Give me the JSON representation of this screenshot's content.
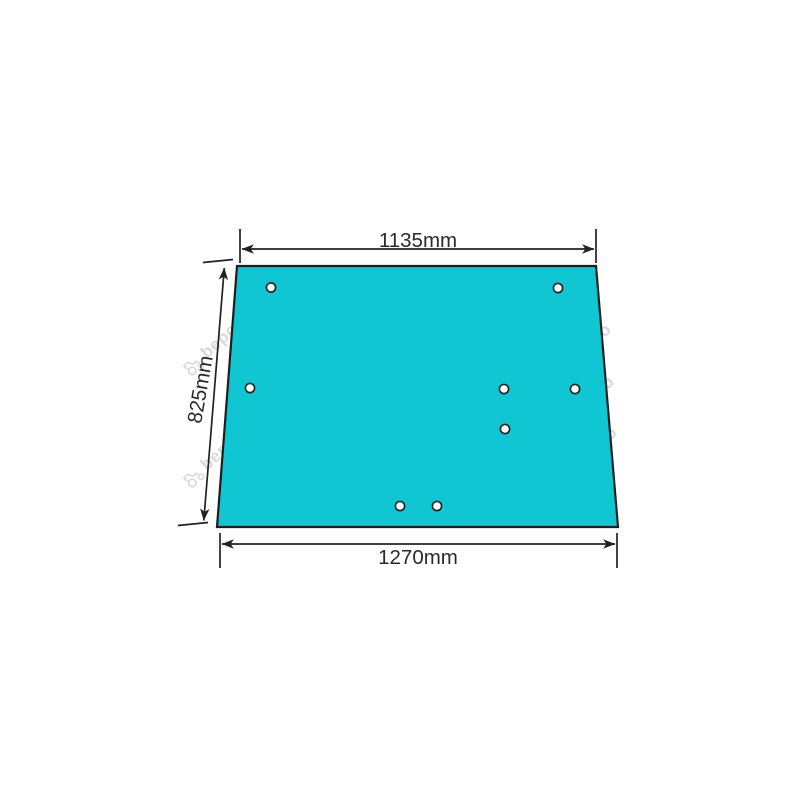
{
  "canvas": {
    "background_color": "#FFFFFF",
    "width_px": 800,
    "height_px": 800
  },
  "diagram": {
    "type": "technical-dimension-drawing",
    "glass_panel": {
      "shape": "trapezoid",
      "fill_color": "#10C6D3",
      "outline_color": "#1E1E1E"
    },
    "dimensions": {
      "top_width": "1135mm",
      "side_height": "825mm",
      "bottom_width": "1270mm"
    },
    "annotation_style": {
      "line_color": "#222222",
      "text_color": "#2A2A2A"
    },
    "holes": {
      "count": 8,
      "radius_px": 4.6,
      "positions_px": [
        [
          271,
          287.5
        ],
        [
          558,
          288
        ],
        [
          250,
          388
        ],
        [
          504,
          389
        ],
        [
          575,
          389
        ],
        [
          505,
          429
        ],
        [
          400,
          506
        ],
        [
          437,
          506
        ]
      ]
    },
    "watermark": {
      "text": "bepco",
      "icon": "tractor-icon",
      "color": "#D8D8D8"
    }
  }
}
